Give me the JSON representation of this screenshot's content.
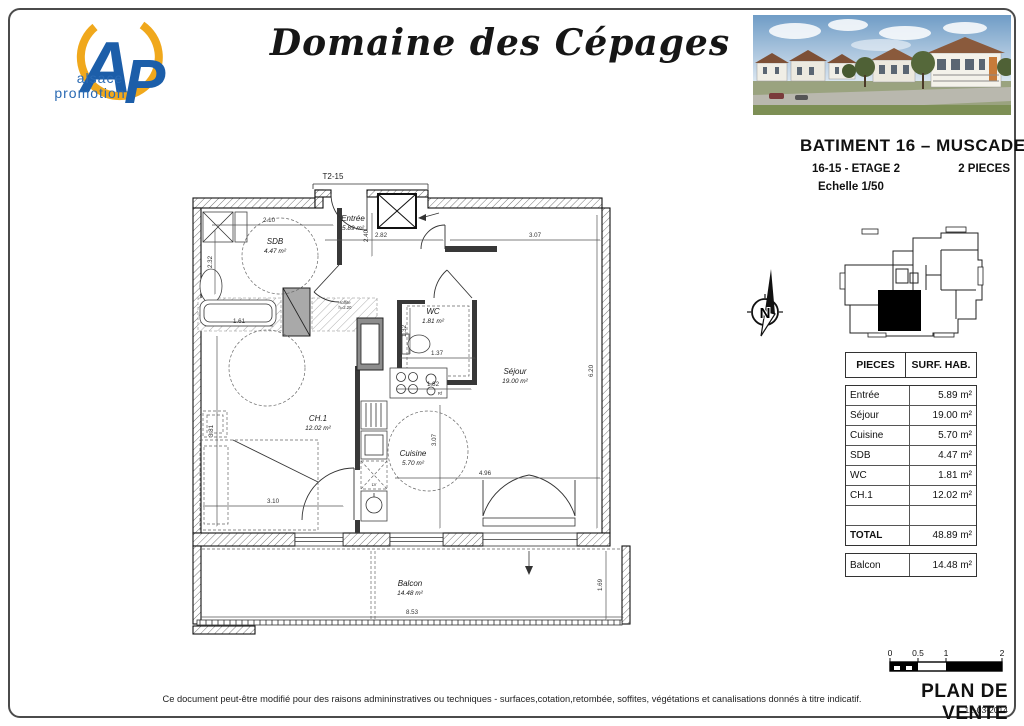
{
  "page": {
    "title": "Domaine des Cépages",
    "disclaimer": "Ce document peut-être modifié pour des raisons admininstratives ou techniques - surfaces,cotation,retombée, soffites, végétations et canalisations donnés à titre indicatif."
  },
  "logo": {
    "letter_a": "A",
    "letter_p": "P",
    "line1": "alsace",
    "line2": "promotion",
    "blue": "#1c5ea9",
    "yellow": "#f0a81c"
  },
  "header": {
    "building": "BATIMENT 16 – MUSCADET",
    "unit": "16-15 - ETAGE 2",
    "type": "2 PIECES",
    "scale": "Echelle 1/50"
  },
  "plan": {
    "unit_tag": "T2-15",
    "north": "N",
    "rooms": [
      {
        "name": "Entrée",
        "area": "5.89 m²"
      },
      {
        "name": "SDB",
        "area": "4.47 m²"
      },
      {
        "name": "WC",
        "area": "1.81 m²"
      },
      {
        "name": "Séjour",
        "area": "19.00 m²"
      },
      {
        "name": "CH.1",
        "area": "12.02 m²"
      },
      {
        "name": "Cuisine",
        "area": "5.70 m²"
      },
      {
        "name": "Balcon",
        "area": "14.48 m²"
      }
    ],
    "dims": {
      "sdb_w": "2.10",
      "sdb_h": "2.32",
      "entree_w": "2.82",
      "entree_h": "2.40",
      "sejour_top_w": "3.07",
      "wc_h": "1.32",
      "wc_w": "1.37",
      "bath_w": "1.61",
      "kitchen_w": "1.82",
      "sejour_h": "6.20",
      "ch1_h": "3.81",
      "kitchen_h": "3.07",
      "ch1_w": "3.10",
      "sejour_w": "4.96",
      "balcon_w": "8.53",
      "balcon_h": "1.69"
    },
    "notes": {
      "soffite_line1": "soffite",
      "soffite_line2": "h=2.20",
      "lv": "LV",
      "rf": "Rf"
    }
  },
  "table": {
    "headers": [
      "PIECES",
      "SURF. HAB."
    ],
    "rows": [
      {
        "name": "Entrée",
        "area": "5.89 m²"
      },
      {
        "name": "Séjour",
        "area": "19.00 m²"
      },
      {
        "name": "Cuisine",
        "area": "5.70 m²"
      },
      {
        "name": "SDB",
        "area": "4.47 m²"
      },
      {
        "name": "WC",
        "area": "1.81 m²"
      },
      {
        "name": "CH.1",
        "area": "12.02 m²"
      }
    ],
    "total": {
      "name": "TOTAL",
      "area": "48.89 m²"
    },
    "balcony": {
      "name": "Balcon",
      "area": "14.48 m²"
    }
  },
  "footer": {
    "scale_ticks": [
      "0",
      "0.5",
      "1",
      "2"
    ],
    "doc_label": "PLAN DE VENTE",
    "date": "12-03-2014"
  }
}
